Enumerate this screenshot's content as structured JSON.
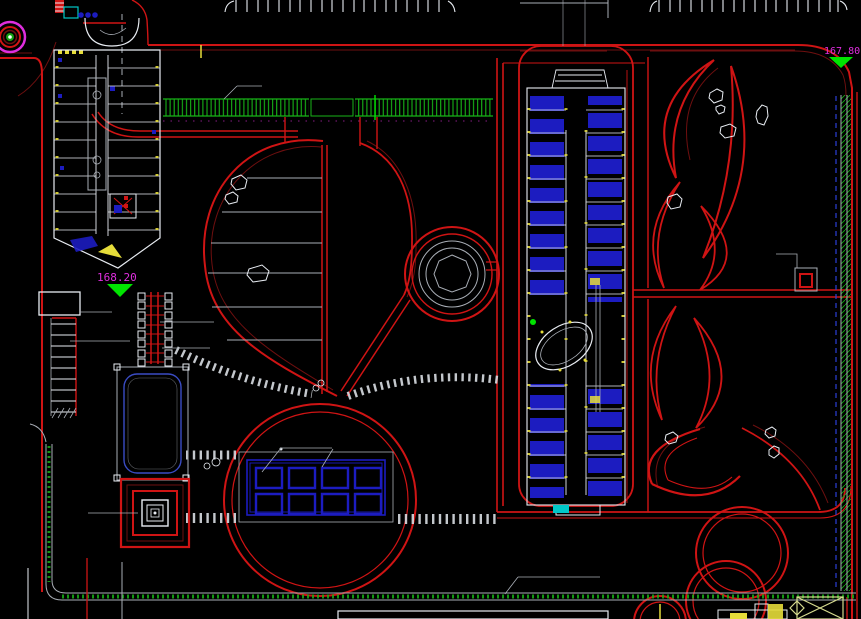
{
  "app": {
    "name": "cad-site-plan-viewport",
    "description": "CAD landscape site plan drawing on black model space"
  },
  "canvas": {
    "width": 861,
    "height": 619,
    "background": "#000000"
  },
  "labels": {
    "elevation_left": "168.20",
    "elevation_right": "167.80"
  },
  "colors": {
    "bg": "#000000",
    "road": "#cf1414",
    "road_dark": "#6e0f0f",
    "line": "#a9aeb6",
    "building": "#e8ecf2",
    "stone": "#d8dde2",
    "room_blue": "#1c1cc0",
    "pool_blue": "#3a4cc4",
    "yellow": "#e6dd3a",
    "green": "#17b317",
    "green_bright": "#00e400",
    "magenta": "#df2ede",
    "cyan": "#00c8c8",
    "blue_dash": "#2c3fd8",
    "pale": "#d6da8e"
  },
  "features": [
    "site-boundary-road",
    "left-building-plan",
    "center-building-plan",
    "teardrop-lawn",
    "leaf-petal-path",
    "circular-fountain",
    "green-trellis-walk",
    "crescent-planting-beds",
    "stepping-stone-paths",
    "swimming-pool",
    "square-pavilion",
    "pergola-walk",
    "stair-ramp",
    "parking-stalls",
    "grid-plaza",
    "tree-symbols",
    "elevation-markers",
    "detail-marker-box",
    "title-strip"
  ]
}
